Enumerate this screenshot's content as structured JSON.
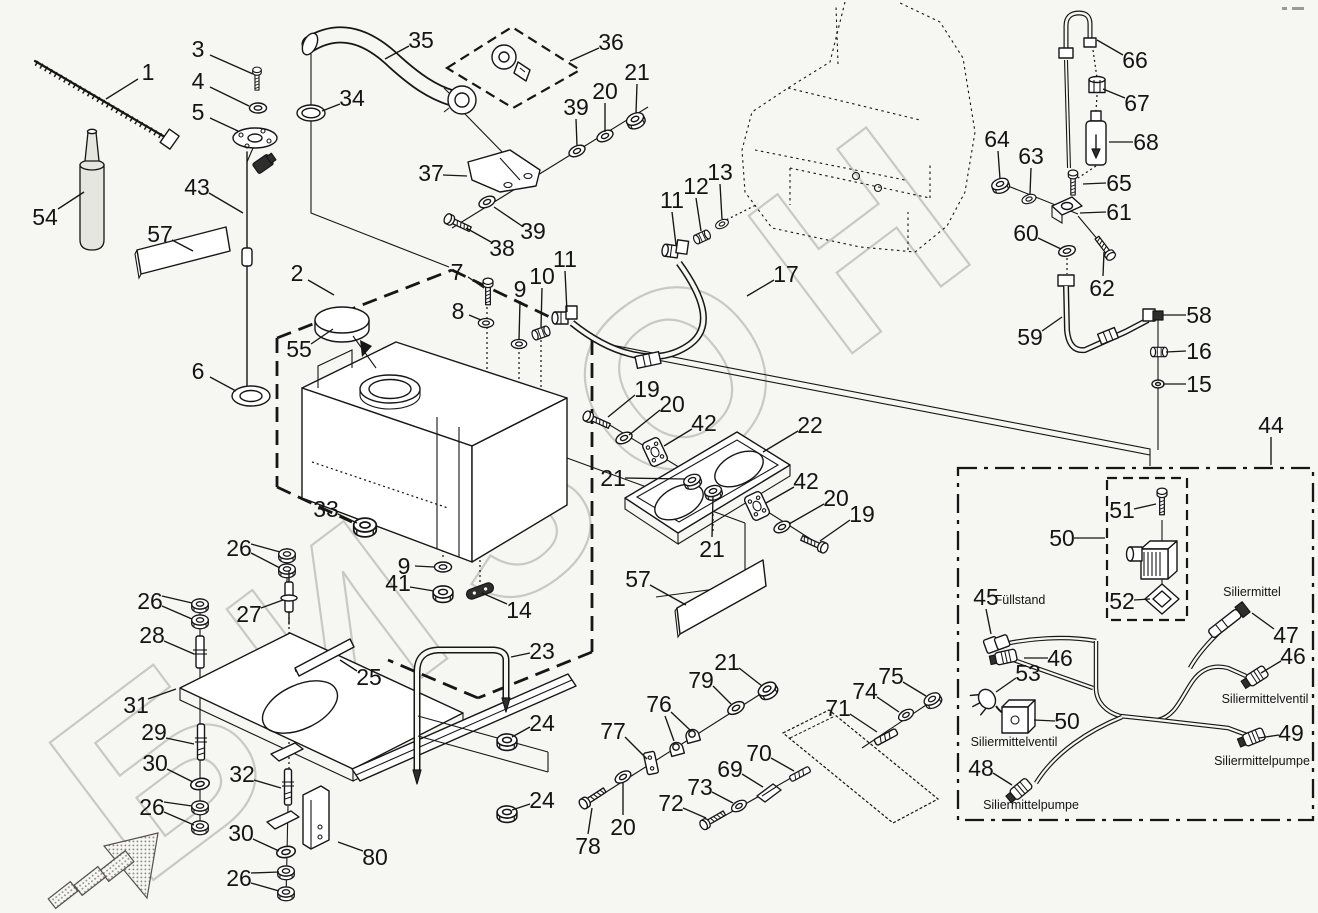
{
  "page": {
    "bg": "#f6f6f2",
    "ink": "#161616",
    "watermark": {
      "text": "БИЗОН",
      "color": "#c9c9c4"
    }
  },
  "texts": {
    "fuellstand": "Füllstand",
    "siliermittel": "Siliermittel",
    "ventil_left": "Siliermittelventil",
    "pumpe_left": "Siliermittelpumpe",
    "ventil_right": "Siliermittelventil",
    "pumpe_right": "Siliermittelpumpe"
  },
  "annotations": [
    {
      "key": "fuellstand",
      "x": 1020,
      "y": 600
    },
    {
      "key": "siliermittel",
      "x": 1252,
      "y": 592
    },
    {
      "key": "ventil_left",
      "x": 1014,
      "y": 742
    },
    {
      "key": "pumpe_left",
      "x": 1031,
      "y": 805
    },
    {
      "key": "ventil_right",
      "x": 1265,
      "y": 699
    },
    {
      "key": "pumpe_right",
      "x": 1262,
      "y": 761
    }
  ],
  "callouts": [
    {
      "n": "1",
      "x": 148,
      "y": 72,
      "leads": [
        [
          138,
          79,
          106,
          99
        ]
      ]
    },
    {
      "n": "3",
      "x": 198,
      "y": 49,
      "leads": [
        [
          210,
          55,
          253,
          74
        ]
      ]
    },
    {
      "n": "4",
      "x": 198,
      "y": 81,
      "leads": [
        [
          210,
          87,
          249,
          106
        ]
      ]
    },
    {
      "n": "5",
      "x": 198,
      "y": 112,
      "leads": [
        [
          210,
          118,
          238,
          131
        ]
      ]
    },
    {
      "n": "54",
      "x": 45,
      "y": 217,
      "leads": [
        [
          58,
          209,
          84,
          192
        ]
      ]
    },
    {
      "n": "57",
      "x": 160,
      "y": 234,
      "leads": [
        [
          172,
          240,
          193,
          251
        ]
      ]
    },
    {
      "n": "43",
      "x": 197,
      "y": 187,
      "leads": [
        [
          209,
          193,
          243,
          213
        ]
      ]
    },
    {
      "n": "6",
      "x": 198,
      "y": 371,
      "leads": [
        [
          210,
          377,
          236,
          391
        ]
      ]
    },
    {
      "n": "2",
      "x": 297,
      "y": 273,
      "leads": [
        [
          308,
          280,
          334,
          295
        ]
      ]
    },
    {
      "n": "55",
      "x": 299,
      "y": 349,
      "leads": [
        [
          311,
          344,
          333,
          329
        ]
      ]
    },
    {
      "n": "33",
      "x": 326,
      "y": 509,
      "leads": [
        [
          338,
          514,
          357,
          523
        ]
      ]
    },
    {
      "n": "9",
      "x": 404,
      "y": 566,
      "leads": [
        [
          415,
          566,
          434,
          567
        ]
      ]
    },
    {
      "n": "41",
      "x": 398,
      "y": 583,
      "leads": [
        [
          410,
          587,
          434,
          591
        ]
      ]
    },
    {
      "n": "14",
      "x": 519,
      "y": 610,
      "leads": [
        [
          507,
          604,
          482,
          593
        ]
      ]
    },
    {
      "n": "35",
      "x": 421,
      "y": 40,
      "leads": [
        [
          409,
          46,
          385,
          59
        ]
      ]
    },
    {
      "n": "34",
      "x": 352,
      "y": 98,
      "leads": [
        [
          340,
          104,
          322,
          111
        ]
      ]
    },
    {
      "n": "36",
      "x": 611,
      "y": 42,
      "leads": [
        [
          599,
          48,
          570,
          61
        ]
      ]
    },
    {
      "n": "37",
      "x": 431,
      "y": 173,
      "leads": [
        [
          443,
          175,
          467,
          176
        ]
      ]
    },
    {
      "n": "38",
      "x": 502,
      "y": 248,
      "leads": [
        [
          491,
          242,
          466,
          228
        ]
      ]
    },
    {
      "n": "39",
      "x": 533,
      "y": 231,
      "leads": [
        [
          522,
          226,
          494,
          207
        ]
      ]
    },
    {
      "n": "39",
      "x": 576,
      "y": 107,
      "leads": [
        [
          576,
          119,
          577,
          146
        ]
      ]
    },
    {
      "n": "20",
      "x": 605,
      "y": 91,
      "leads": [
        [
          605,
          103,
          605,
          132
        ]
      ]
    },
    {
      "n": "21",
      "x": 637,
      "y": 72,
      "leads": [
        [
          637,
          84,
          636,
          113
        ]
      ]
    },
    {
      "n": "7",
      "x": 457,
      "y": 272,
      "leads": [
        [
          468,
          277,
          484,
          288
        ]
      ]
    },
    {
      "n": "8",
      "x": 458,
      "y": 311,
      "leads": [
        [
          469,
          315,
          481,
          320
        ]
      ]
    },
    {
      "n": "9",
      "x": 520,
      "y": 289,
      "leads": [
        [
          520,
          301,
          519,
          340
        ]
      ]
    },
    {
      "n": "10",
      "x": 542,
      "y": 276,
      "leads": [
        [
          542,
          288,
          541,
          327
        ]
      ]
    },
    {
      "n": "11",
      "x": 565,
      "y": 259,
      "leads": [
        [
          565,
          271,
          567,
          312
        ]
      ]
    },
    {
      "n": "11",
      "x": 672,
      "y": 200,
      "leads": [
        [
          672,
          212,
          676,
          245
        ]
      ]
    },
    {
      "n": "12",
      "x": 696,
      "y": 186,
      "leads": [
        [
          696,
          198,
          701,
          231
        ]
      ]
    },
    {
      "n": "13",
      "x": 720,
      "y": 172,
      "leads": [
        [
          720,
          184,
          722,
          219
        ]
      ]
    },
    {
      "n": "17",
      "x": 786,
      "y": 274,
      "leads": [
        [
          774,
          280,
          747,
          296
        ]
      ]
    },
    {
      "n": "66",
      "x": 1135,
      "y": 60,
      "leads": [
        [
          1123,
          55,
          1097,
          40
        ]
      ]
    },
    {
      "n": "67",
      "x": 1137,
      "y": 103,
      "leads": [
        [
          1125,
          98,
          1103,
          89
        ]
      ]
    },
    {
      "n": "68",
      "x": 1146,
      "y": 142,
      "leads": [
        [
          1133,
          142,
          1109,
          142
        ]
      ]
    },
    {
      "n": "65",
      "x": 1119,
      "y": 183,
      "leads": [
        [
          1106,
          183,
          1083,
          184
        ]
      ]
    },
    {
      "n": "64",
      "x": 997,
      "y": 139,
      "leads": [
        [
          998,
          151,
          1000,
          179
        ]
      ]
    },
    {
      "n": "63",
      "x": 1031,
      "y": 156,
      "leads": [
        [
          1031,
          168,
          1030,
          194
        ]
      ]
    },
    {
      "n": "61",
      "x": 1119,
      "y": 212,
      "leads": [
        [
          1106,
          212,
          1080,
          213
        ]
      ]
    },
    {
      "n": "60",
      "x": 1026,
      "y": 233,
      "leads": [
        [
          1038,
          238,
          1061,
          249
        ]
      ]
    },
    {
      "n": "62",
      "x": 1102,
      "y": 288,
      "leads": [
        [
          1103,
          276,
          1104,
          252
        ]
      ]
    },
    {
      "n": "59",
      "x": 1030,
      "y": 337,
      "leads": [
        [
          1042,
          331,
          1062,
          317
        ]
      ]
    },
    {
      "n": "58",
      "x": 1199,
      "y": 315,
      "leads": [
        [
          1186,
          315,
          1163,
          315
        ]
      ]
    },
    {
      "n": "16",
      "x": 1199,
      "y": 351,
      "leads": [
        [
          1186,
          351,
          1166,
          352
        ]
      ]
    },
    {
      "n": "15",
      "x": 1199,
      "y": 384,
      "leads": [
        [
          1186,
          384,
          1163,
          384
        ]
      ]
    },
    {
      "n": "44",
      "x": 1271,
      "y": 425,
      "leads": [
        [
          1271,
          437,
          1271,
          465
        ]
      ]
    },
    {
      "n": "19",
      "x": 647,
      "y": 389,
      "leads": [
        [
          635,
          395,
          608,
          417
        ]
      ]
    },
    {
      "n": "20",
      "x": 672,
      "y": 404,
      "leads": [
        [
          660,
          410,
          629,
          435
        ]
      ]
    },
    {
      "n": "42",
      "x": 704,
      "y": 423,
      "leads": [
        [
          692,
          429,
          664,
          446
        ]
      ]
    },
    {
      "n": "21",
      "x": 613,
      "y": 478,
      "leads": [
        [
          625,
          478,
          685,
          479
        ]
      ]
    },
    {
      "n": "22",
      "x": 810,
      "y": 425,
      "leads": [
        [
          798,
          431,
          763,
          452
        ]
      ]
    },
    {
      "n": "21",
      "x": 712,
      "y": 549,
      "leads": [
        [
          712,
          537,
          713,
          496
        ]
      ]
    },
    {
      "n": "42",
      "x": 806,
      "y": 481,
      "leads": [
        [
          794,
          487,
          766,
          503
        ]
      ]
    },
    {
      "n": "20",
      "x": 836,
      "y": 498,
      "leads": [
        [
          824,
          504,
          789,
          524
        ]
      ]
    },
    {
      "n": "19",
      "x": 862,
      "y": 514,
      "leads": [
        [
          850,
          520,
          820,
          541
        ]
      ]
    },
    {
      "n": "57",
      "x": 638,
      "y": 579,
      "leads": [
        [
          650,
          585,
          686,
          605
        ]
      ]
    },
    {
      "n": "26",
      "x": 239,
      "y": 548,
      "leads": [
        [
          251,
          544,
          280,
          552
        ],
        [
          251,
          553,
          280,
          568
        ]
      ]
    },
    {
      "n": "27",
      "x": 249,
      "y": 614,
      "leads": [
        [
          261,
          608,
          283,
          600
        ]
      ]
    },
    {
      "n": "26",
      "x": 150,
      "y": 601,
      "leads": [
        [
          162,
          596,
          192,
          603
        ],
        [
          162,
          606,
          192,
          619
        ]
      ]
    },
    {
      "n": "28",
      "x": 152,
      "y": 635,
      "leads": [
        [
          164,
          641,
          194,
          654
        ]
      ]
    },
    {
      "n": "31",
      "x": 136,
      "y": 705,
      "leads": [
        [
          148,
          699,
          176,
          689
        ]
      ]
    },
    {
      "n": "29",
      "x": 154,
      "y": 732,
      "leads": [
        [
          166,
          738,
          194,
          744
        ]
      ]
    },
    {
      "n": "30",
      "x": 155,
      "y": 763,
      "leads": [
        [
          167,
          769,
          193,
          782
        ]
      ]
    },
    {
      "n": "26",
      "x": 152,
      "y": 807,
      "leads": [
        [
          164,
          802,
          192,
          806
        ],
        [
          164,
          812,
          194,
          825
        ]
      ]
    },
    {
      "n": "25",
      "x": 369,
      "y": 677,
      "leads": [
        [
          357,
          671,
          340,
          660
        ]
      ]
    },
    {
      "n": "32",
      "x": 242,
      "y": 774,
      "leads": [
        [
          254,
          780,
          281,
          788
        ]
      ]
    },
    {
      "n": "30",
      "x": 241,
      "y": 833,
      "leads": [
        [
          253,
          839,
          279,
          851
        ]
      ]
    },
    {
      "n": "26",
      "x": 239,
      "y": 878,
      "leads": [
        [
          251,
          873,
          279,
          872
        ],
        [
          251,
          883,
          279,
          891
        ]
      ]
    },
    {
      "n": "80",
      "x": 375,
      "y": 857,
      "leads": [
        [
          363,
          851,
          338,
          842
        ]
      ]
    },
    {
      "n": "23",
      "x": 542,
      "y": 651,
      "leads": [
        [
          530,
          653,
          511,
          657
        ]
      ]
    },
    {
      "n": "24",
      "x": 542,
      "y": 723,
      "leads": [
        [
          530,
          727,
          512,
          737
        ]
      ]
    },
    {
      "n": "24",
      "x": 542,
      "y": 800,
      "leads": [
        [
          530,
          804,
          512,
          810
        ]
      ]
    },
    {
      "n": "78",
      "x": 588,
      "y": 846,
      "leads": [
        [
          588,
          834,
          592,
          808
        ]
      ]
    },
    {
      "n": "20",
      "x": 623,
      "y": 827,
      "leads": [
        [
          623,
          815,
          623,
          782
        ]
      ]
    },
    {
      "n": "77",
      "x": 613,
      "y": 731,
      "leads": [
        [
          625,
          737,
          647,
          759
        ]
      ]
    },
    {
      "n": "76",
      "x": 659,
      "y": 704,
      "leads": [
        [
          665,
          716,
          674,
          741
        ],
        [
          671,
          712,
          690,
          730
        ]
      ]
    },
    {
      "n": "79",
      "x": 701,
      "y": 680,
      "leads": [
        [
          713,
          686,
          731,
          704
        ]
      ]
    },
    {
      "n": "21",
      "x": 727,
      "y": 662,
      "leads": [
        [
          739,
          668,
          762,
          686
        ]
      ]
    },
    {
      "n": "72",
      "x": 671,
      "y": 803,
      "leads": [
        [
          683,
          808,
          706,
          818
        ]
      ]
    },
    {
      "n": "73",
      "x": 700,
      "y": 787,
      "leads": [
        [
          712,
          792,
          733,
          803
        ]
      ]
    },
    {
      "n": "69",
      "x": 730,
      "y": 769,
      "leads": [
        [
          742,
          774,
          763,
          787
        ]
      ]
    },
    {
      "n": "70",
      "x": 759,
      "y": 753,
      "leads": [
        [
          771,
          758,
          794,
          771
        ]
      ]
    },
    {
      "n": "71",
      "x": 838,
      "y": 708,
      "leads": [
        [
          850,
          714,
          877,
          732
        ]
      ]
    },
    {
      "n": "74",
      "x": 865,
      "y": 691,
      "leads": [
        [
          877,
          697,
          899,
          712
        ]
      ]
    },
    {
      "n": "75",
      "x": 891,
      "y": 676,
      "leads": [
        [
          903,
          682,
          926,
          696
        ]
      ]
    },
    {
      "n": "51",
      "x": 1122,
      "y": 510,
      "leads": [
        [
          1134,
          509,
          1156,
          504
        ]
      ]
    },
    {
      "n": "50",
      "x": 1062,
      "y": 538,
      "leads": [
        [
          1074,
          538,
          1105,
          538
        ]
      ]
    },
    {
      "n": "52",
      "x": 1122,
      "y": 601,
      "leads": [
        [
          1134,
          600,
          1150,
          599
        ]
      ]
    },
    {
      "n": "45",
      "x": 986,
      "y": 597,
      "leads": [
        [
          986,
          609,
          991,
          634
        ]
      ]
    },
    {
      "n": "46",
      "x": 1060,
      "y": 658,
      "leads": [
        [
          1048,
          658,
          1024,
          658
        ]
      ]
    },
    {
      "n": "53",
      "x": 1028,
      "y": 673,
      "leads": [
        [
          1016,
          678,
          996,
          692
        ]
      ]
    },
    {
      "n": "50",
      "x": 1067,
      "y": 721,
      "leads": [
        [
          1055,
          721,
          1034,
          720
        ]
      ]
    },
    {
      "n": "48",
      "x": 981,
      "y": 768,
      "leads": [
        [
          993,
          773,
          1012,
          785
        ]
      ]
    },
    {
      "n": "47",
      "x": 1286,
      "y": 635,
      "leads": [
        [
          1274,
          629,
          1252,
          613
        ]
      ]
    },
    {
      "n": "46",
      "x": 1293,
      "y": 656,
      "leads": [
        [
          1281,
          661,
          1261,
          673
        ]
      ]
    },
    {
      "n": "49",
      "x": 1291,
      "y": 733,
      "leads": [
        [
          1279,
          735,
          1259,
          738
        ]
      ]
    }
  ]
}
